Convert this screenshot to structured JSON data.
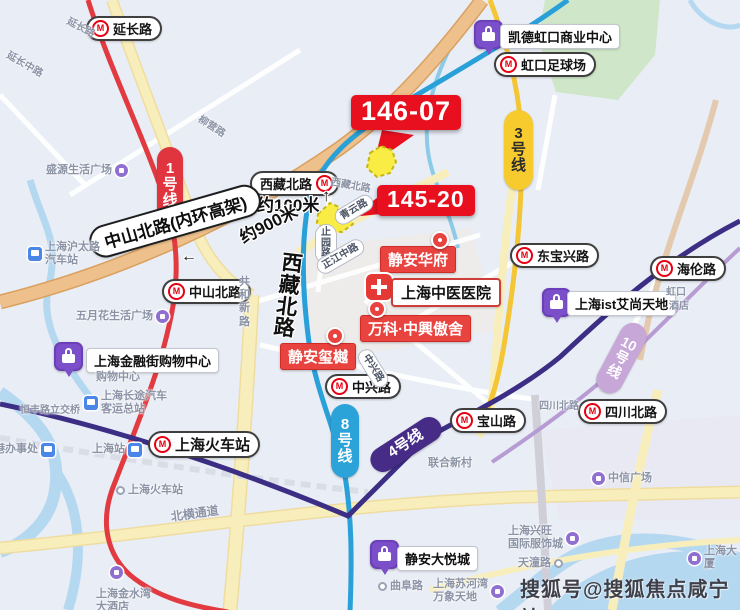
{
  "map": {
    "watermark": {
      "text": "搜狐号@搜狐焦点咸宁站"
    },
    "badges": [
      {
        "name": "parcel-badge-146-07",
        "label": "146-07",
        "x": 351,
        "y": 95,
        "fs": 27,
        "tail": "down-left"
      },
      {
        "name": "parcel-badge-145-20",
        "label": "145-20",
        "x": 377,
        "y": 185,
        "fs": 23,
        "tail": "left"
      }
    ],
    "stations": [
      {
        "name": "yanchang-road",
        "label": "延长路",
        "x": 86,
        "y": 16,
        "icon": "left",
        "fs": 13
      },
      {
        "name": "xizang-north-road",
        "label": "西藏北路",
        "x": 250,
        "y": 171,
        "icon": "right",
        "fs": 13
      },
      {
        "name": "zhongshan-north-road",
        "label": "中山北路",
        "x": 162,
        "y": 279,
        "icon": "left",
        "fs": 13
      },
      {
        "name": "hongkou-football-stadium",
        "label": "虹口足球场",
        "x": 494,
        "y": 52,
        "icon": "left",
        "fs": 13
      },
      {
        "name": "dongbaoxing-road",
        "label": "东宝兴路",
        "x": 510,
        "y": 243,
        "icon": "left",
        "fs": 13
      },
      {
        "name": "hailun-road",
        "label": "海伦路",
        "x": 650,
        "y": 256,
        "icon": "left",
        "fs": 13
      },
      {
        "name": "zhongxing-road",
        "label": "中兴路",
        "x": 325,
        "y": 374,
        "icon": "left",
        "fs": 13
      },
      {
        "name": "baoshan-road",
        "label": "宝山路",
        "x": 450,
        "y": 408,
        "icon": "left",
        "fs": 13
      },
      {
        "name": "sichuan-north-road",
        "label": "四川北路",
        "x": 578,
        "y": 399,
        "icon": "left",
        "fs": 13
      },
      {
        "name": "shanghai-railway-station",
        "label": "上海火车站",
        "x": 148,
        "y": 431,
        "icon": "left",
        "fs": 15
      }
    ],
    "line_pills": [
      {
        "name": "line-1",
        "label": "1号线",
        "x": 157,
        "y": 147,
        "w": 26,
        "h": 76,
        "vertical": true,
        "rot": 0,
        "bg": "#e0353f",
        "fg": "#ffffff",
        "fs": 15
      },
      {
        "name": "line-3",
        "label": "3号线",
        "x": 504,
        "y": 110,
        "w": 29,
        "h": 80,
        "vertical": true,
        "rot": 0,
        "bg": "#f7ca2e",
        "fg": "#2b2b2b",
        "fs": 15
      },
      {
        "name": "line-8",
        "label": "8号线",
        "x": 331,
        "y": 404,
        "w": 28,
        "h": 74,
        "vertical": true,
        "rot": 0,
        "bg": "#2ba3d8",
        "fg": "#ffffff",
        "fs": 15
      },
      {
        "name": "line-4",
        "label": "4号线",
        "x": 366,
        "y": 432,
        "w": 80,
        "h": 25,
        "vertical": false,
        "rot": -33,
        "bg": "#462c86",
        "fg": "#ffffff",
        "fs": 15
      },
      {
        "name": "line-10",
        "label": "10号线",
        "x": 608,
        "y": 320,
        "w": 27,
        "h": 76,
        "vertical": true,
        "rot": 28,
        "bg": "#c7a6d8",
        "fg": "#ffffff",
        "fs": 14
      }
    ],
    "red_pois": [
      {
        "name": "jingan-huafu",
        "label": "静安华府",
        "x": 380,
        "y": 246,
        "fs": 15
      },
      {
        "name": "vanke-zhongxing-aoshe",
        "label": "万科·中興傲舍",
        "x": 360,
        "y": 315,
        "fs": 15
      },
      {
        "name": "jingan-xiyue",
        "label": "静安玺樾",
        "x": 280,
        "y": 343,
        "fs": 15
      }
    ],
    "pins": [
      {
        "x": 431,
        "y": 231
      },
      {
        "x": 368,
        "y": 300
      },
      {
        "x": 326,
        "y": 327
      }
    ],
    "hospital": {
      "label": "上海中医医院",
      "icon_x": 366,
      "icon_y": 274,
      "x": 391,
      "y": 278,
      "fs": 15
    },
    "malls": [
      {
        "name": "capitaland-hongkou-plaza",
        "label": "凯德虹口商业中心",
        "ix": 474,
        "iy": 20,
        "tx": 500,
        "ty": 24,
        "fs": 13
      },
      {
        "name": "shanghai-ist",
        "label": "上海ist艾尚天地",
        "ix": 542,
        "iy": 288,
        "tx": 567,
        "ty": 291,
        "fs": 13
      },
      {
        "name": "financial-street-mall",
        "label": "上海金融街购物中心",
        "ix": 54,
        "iy": 342,
        "tx": 86,
        "ty": 348,
        "fs": 13
      },
      {
        "name": "jingan-joy-city",
        "label": "静安大悦城",
        "ix": 370,
        "iy": 540,
        "tx": 397,
        "ty": 546,
        "fs": 13
      }
    ],
    "road_pills": [
      {
        "name": "qingyun-road",
        "label": "青云路",
        "x": 336,
        "y": 212,
        "rot": -31,
        "vertical": false
      },
      {
        "name": "zhiyuan-road",
        "label": "止园路",
        "x": 315,
        "y": 224,
        "rot": 0,
        "vertical": true
      },
      {
        "name": "zhengjiang-middle",
        "label": "正江中路",
        "x": 318,
        "y": 261,
        "rot": -30,
        "vertical": false
      },
      {
        "name": "zhongxing-street",
        "label": "中兴路",
        "x": 362,
        "y": 342,
        "rot": 58,
        "vertical": false
      }
    ],
    "annotations": [
      {
        "name": "distance-100m",
        "label": "约100米",
        "x": 257,
        "y": 197,
        "rot": 0,
        "fs": 17,
        "vertical": false
      },
      {
        "name": "arrow-up",
        "label": "↑",
        "x": 322,
        "y": 187,
        "rot": 0,
        "fs": 17,
        "vertical": false
      },
      {
        "name": "distance-900m",
        "label": "约900米",
        "x": 237,
        "y": 231,
        "rot": -27,
        "fs": 17,
        "vertical": false
      },
      {
        "name": "arrow-left",
        "label": "←",
        "x": 181,
        "y": 249,
        "rot": 0,
        "fs": 16,
        "vertical": false
      },
      {
        "name": "xizang-north-vertical",
        "label": "西藏北路",
        "x": 283,
        "y": 252,
        "rot": 7,
        "fs": 21,
        "vertical": true
      }
    ],
    "elevated_label": {
      "label": "中山北路(内环高架)",
      "x": 90,
      "y": 229,
      "rot": -16,
      "fs": 17
    },
    "gray_labels": [
      {
        "label": "延长路",
        "x": 70,
        "y": 16,
        "rot": 28,
        "fs": 10,
        "icon": "none"
      },
      {
        "label": "延长中路",
        "x": 10,
        "y": 50,
        "rot": 30,
        "fs": 10,
        "icon": "none"
      },
      {
        "label": "柳营路",
        "x": 202,
        "y": 114,
        "rot": 33,
        "fs": 10,
        "icon": "none"
      },
      {
        "label": "西藏北路",
        "x": 332,
        "y": 177,
        "rot": 10,
        "fs": 10,
        "icon": "none"
      },
      {
        "label": "盛源生活广场",
        "x": 46,
        "y": 164,
        "rot": 0,
        "fs": 11,
        "icon": "pdot-right"
      },
      {
        "label": "五月花生活广场",
        "x": 76,
        "y": 310,
        "rot": 0,
        "fs": 11,
        "icon": "pdot-right"
      },
      {
        "label": "上海沪太路\n汽车站",
        "x": 28,
        "y": 241,
        "rot": 0,
        "fs": 11,
        "icon": "blue-left"
      },
      {
        "label": "恒丰路立交桥",
        "x": 20,
        "y": 405,
        "rot": 0,
        "fs": 10,
        "icon": "none"
      },
      {
        "label": "港办事处",
        "x": -6,
        "y": 443,
        "rot": 0,
        "fs": 11,
        "icon": "blue-right"
      },
      {
        "label": "上海站",
        "x": 92,
        "y": 443,
        "rot": 0,
        "fs": 11,
        "icon": "blue-right"
      },
      {
        "label": "上海火车站",
        "x": 116,
        "y": 484,
        "rot": 0,
        "fs": 11,
        "icon": "dot-left"
      },
      {
        "label": "购物中心",
        "x": 96,
        "y": 371,
        "rot": 0,
        "fs": 11,
        "icon": "none"
      },
      {
        "label": "上海长途汽车\n客运总站",
        "x": 84,
        "y": 390,
        "rot": 0,
        "fs": 11,
        "icon": "blue-left"
      },
      {
        "label": "北横通道",
        "x": 170,
        "y": 510,
        "rot": -8,
        "fs": 12,
        "icon": "none"
      },
      {
        "label": "共和新路",
        "x": 239,
        "y": 276,
        "rot": 0,
        "fs": 11,
        "icon": "none",
        "vertical": true
      },
      {
        "label": "联合新村",
        "x": 428,
        "y": 457,
        "rot": 0,
        "fs": 11,
        "icon": "none"
      },
      {
        "label": "四川北路",
        "x": 539,
        "y": 401,
        "rot": 0,
        "fs": 10,
        "icon": "none"
      },
      {
        "label": "中信广场",
        "x": 592,
        "y": 472,
        "rot": 0,
        "fs": 11,
        "icon": "pdot-left"
      },
      {
        "label": "虹口",
        "x": 666,
        "y": 287,
        "rot": 0,
        "fs": 10,
        "icon": "none"
      },
      {
        "label": "酒店",
        "x": 669,
        "y": 301,
        "rot": 0,
        "fs": 10,
        "icon": "none"
      },
      {
        "label": "上海金水湾\n大酒店",
        "x": 96,
        "y": 588,
        "rot": 0,
        "fs": 11,
        "icon": "none"
      },
      {
        "label": "上海兴旺\n国际服饰城",
        "x": 508,
        "y": 525,
        "rot": 0,
        "fs": 11,
        "icon": "pdot-right"
      },
      {
        "label": "天潼路",
        "x": 518,
        "y": 557,
        "rot": 0,
        "fs": 11,
        "icon": "dot-right"
      },
      {
        "label": "曲阜路",
        "x": 378,
        "y": 580,
        "rot": 0,
        "fs": 11,
        "icon": "dot-left"
      },
      {
        "label": "上海苏河湾\n万象天地",
        "x": 433,
        "y": 578,
        "rot": 0,
        "fs": 11,
        "icon": "pdot-right"
      },
      {
        "label": "上海大厦",
        "x": 688,
        "y": 545,
        "rot": 0,
        "fs": 11,
        "icon": "pdot-left"
      }
    ],
    "standalone_dots": [
      {
        "x": 110,
        "y": 566
      }
    ]
  }
}
